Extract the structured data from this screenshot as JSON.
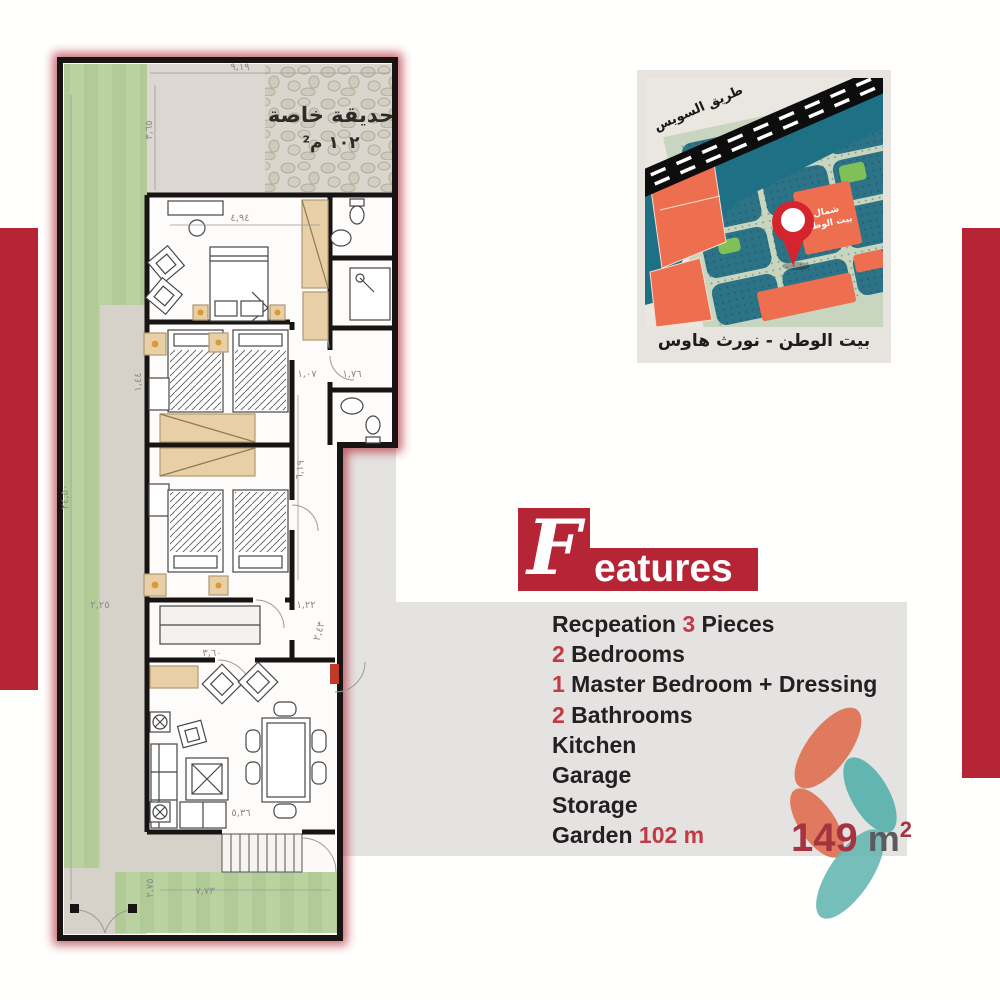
{
  "colors": {
    "accent_red": "#b52536",
    "feature_number_red": "#c13a46",
    "area_red": "#a53340",
    "area_unit_gray": "#5b5b5e",
    "logo_orange": "#e07a5f",
    "logo_teal": "#63b5b1",
    "map_block_teal": "#2c7387",
    "map_parcel_orange": "#ee6e50",
    "map_park_green": "#7fc158",
    "plan_garden_green": "#b9d2a0",
    "panel_gray": "#e4e3e1"
  },
  "map": {
    "road_label": "طريق السويس",
    "district_label_line1": "شمال",
    "district_label_line2": "بيت الوطن",
    "caption": "بيت الوطن - نورث هاوس"
  },
  "plan": {
    "garden_label_line1": "حديقة خاصة",
    "garden_label_line2": "١٠٢ م²",
    "dims": {
      "top_width": "٩,١٩",
      "terrace_depth": "٣,٦٥",
      "master_width": "٤,٩٤",
      "overall_depth": "٢٤,٥٠",
      "left_side": "٢,٢٥",
      "nook": "١,٤٤",
      "hall_length": "٦,١٩",
      "corridor_a": "١,٠٧",
      "corridor_b": "١,٧٦",
      "storage_width": "٣,٦٠",
      "passage": "١,٢٢",
      "passage_b": "٢,٤٣",
      "reception_width": "٥,٣٦",
      "garden_depth": "٢,٧٥",
      "garden_width": "٧,٧٣"
    }
  },
  "features": {
    "title_initial": "F",
    "title_rest": "eatures",
    "items": [
      {
        "pre": "Recpeation ",
        "red": "3",
        "post": " Pieces"
      },
      {
        "pre": "",
        "red": "2",
        "post": " Bedrooms"
      },
      {
        "pre": "",
        "red": "1",
        "post": " Master Bedroom + Dressing"
      },
      {
        "pre": "",
        "red": "2",
        "post": " Bathrooms"
      },
      {
        "pre": "Kitchen",
        "red": "",
        "post": ""
      },
      {
        "pre": "Garage",
        "red": "",
        "post": ""
      },
      {
        "pre": "Storage",
        "red": "",
        "post": ""
      },
      {
        "pre": "Garden ",
        "red": "102 m",
        "post": ""
      }
    ]
  },
  "area": {
    "value": "149",
    "unit": " m",
    "exponent": "2"
  }
}
